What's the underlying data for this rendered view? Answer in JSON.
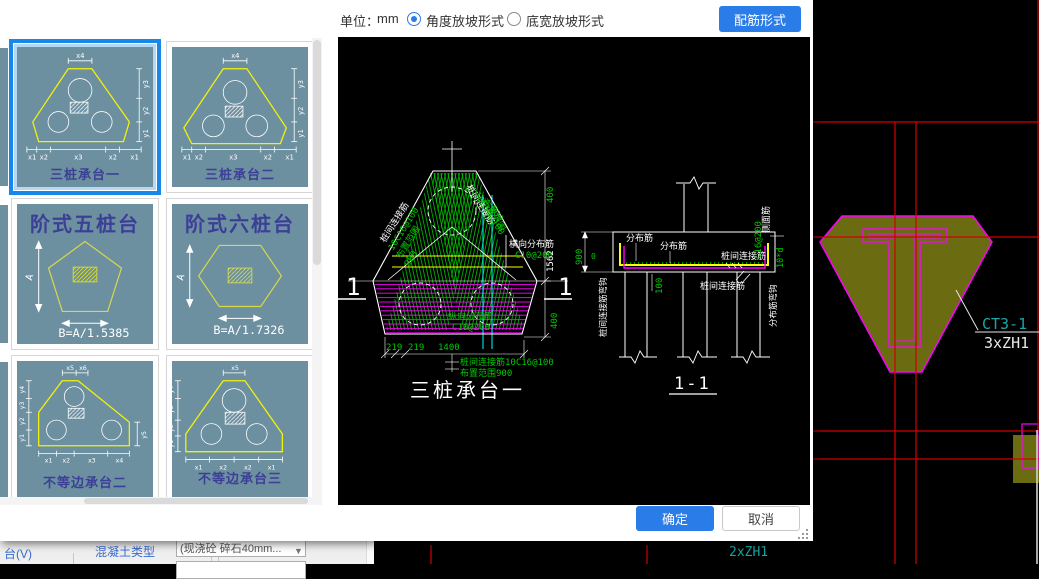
{
  "toolbar": {
    "unit_label": "单位：",
    "unit_value": "mm",
    "radio_angle": "角度放坡形式",
    "radio_width": "底宽放坡形式",
    "rebar_btn": "配筋形式"
  },
  "thumbs": {
    "t1": {
      "caption": "三桩承台一"
    },
    "t2": {
      "caption": "三桩承台二"
    },
    "t3": {
      "title": "阶式五桩台",
      "formula": "B=A/1.5385",
      "dim": "A"
    },
    "t4": {
      "title": "阶式六桩台",
      "formula": "B=A/1.7326",
      "dim": "A"
    },
    "t5": {
      "caption": "不等边承台二"
    },
    "t6": {
      "caption": "不等边承台三"
    },
    "tri_dims": {
      "top": "x4",
      "right": [
        "y3",
        "y2",
        "y1"
      ],
      "bottom": [
        "x1",
        "x2",
        "x3",
        "x2",
        "x1"
      ]
    },
    "irr2_dims": {
      "top": [
        "x5",
        "x6"
      ],
      "left": [
        "y4",
        "y3",
        "y2",
        "y1"
      ],
      "right": "y5",
      "bottom": [
        "x1",
        "x2",
        "x3",
        "x4"
      ]
    },
    "irr3_dims": {
      "top": "x5",
      "left": [
        "y4",
        "y3",
        "y2",
        "y1"
      ],
      "bottom": [
        "x1",
        "x2",
        "x2",
        "x1"
      ]
    }
  },
  "plan": {
    "title": "三桩承台一",
    "stack": [
      "桩间连接筋",
      "10C16@100",
      "布置范围",
      "900"
    ],
    "horiz_label": "横向分布筋",
    "horiz_val": "C10@200",
    "vert_label": "纵向分布筋",
    "vert_val": "C10@200",
    "dim_top": "400",
    "dim_mid": "1562",
    "dim_bot": "400",
    "dim_219": "219",
    "dim_1400": "1400",
    "leader1": "桩间连接筋10C16@100",
    "leader2": "布置范围900",
    "mark": "1"
  },
  "section": {
    "title": "1-1",
    "dist": "分布筋",
    "conn": "桩间连接筋",
    "side_label": "侧面筋",
    "side_val": "C16@200",
    "hook_dist": "分布筋弯钩",
    "hook_conn": "桩间连接筋弯钩",
    "d900": "900",
    "d0": "0",
    "d100": "100",
    "d10d": "10*d"
  },
  "footer": {
    "ok": "确定",
    "cancel": "取消"
  },
  "underlay": {
    "ct_label": "CT3-1",
    "zh_label": "3xZH1",
    "zh_label2": "2xZH1",
    "menu_text": "台(V)",
    "concrete_label": "混凝土类型",
    "concrete_value": "(现浇砼 碎石40mm..."
  },
  "colors": {
    "accent": "#2a7ce9",
    "thumb_bg": "#6d90a1",
    "select_border": "#1787e8",
    "cad_green": "#00c800",
    "cad_magenta": "#ff00ff",
    "cad_yellow": "#ffff00",
    "cad_cyan": "#00ffff",
    "cad_red": "#d40000",
    "cad_olive": "#6b6b12",
    "cad_teal": "#18a7a7",
    "caption_color": "#3b3f96"
  }
}
